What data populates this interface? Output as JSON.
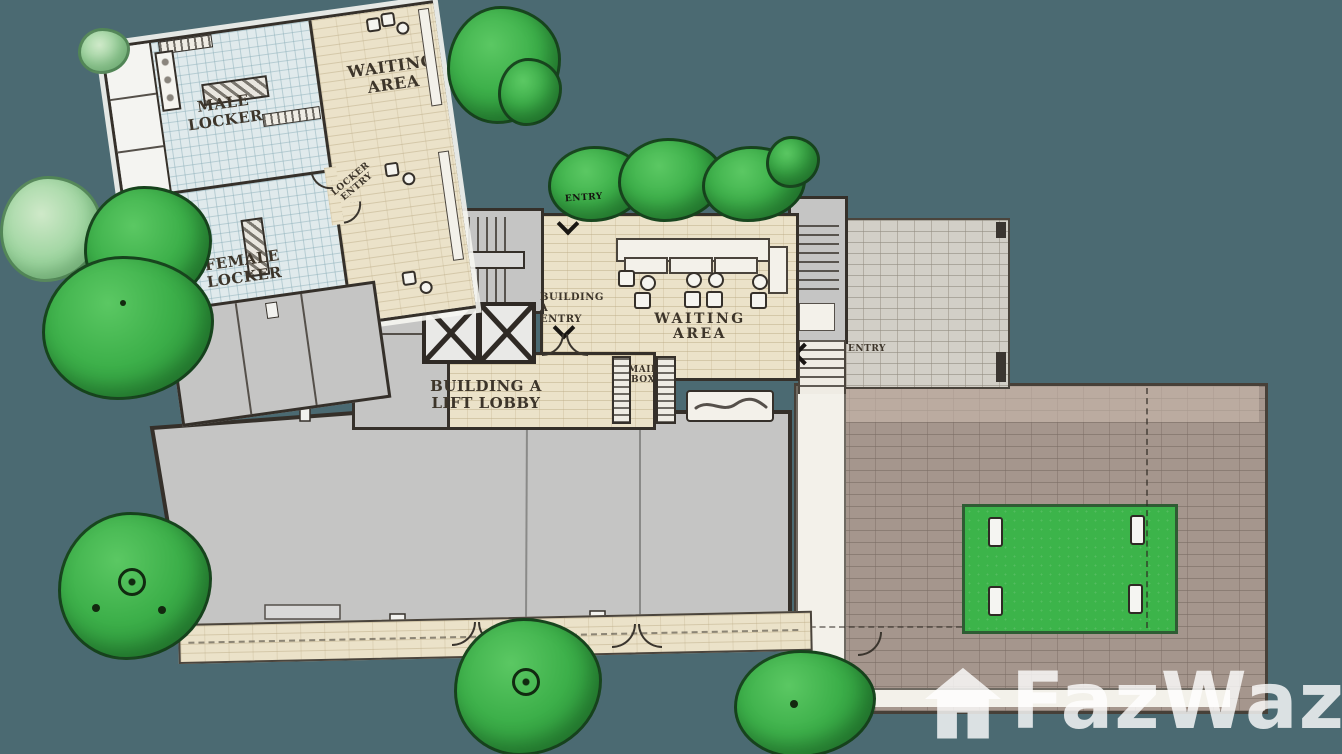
{
  "title": "Building A ground floor plan with locker facilities and entry court",
  "labels": {
    "locker_waiting": {
      "l1": "WAITING",
      "l2": "AREA"
    },
    "male_locker": "MALE LOCKER",
    "female_locker": {
      "l1": "FEMALE",
      "l2": "LOCKER"
    },
    "locker_entry": {
      "l1": "LOCKER",
      "l2": "ENTRY"
    },
    "top_entry": "ENTRY",
    "building_a_entry": {
      "l1": "BUILDING A",
      "l2": "ENTRY"
    },
    "main_waiting": "WAITING AREA",
    "lift_lobby": {
      "l1": "BUILDING A",
      "l2": "LIFT LOBBY"
    },
    "mail_box": {
      "l1": "MAIL",
      "l2": "BOX"
    },
    "side_entry": "ENTRY"
  },
  "watermark": {
    "brand": "FazWaz",
    "icon": "house-icon"
  },
  "colors": {
    "background": "#4b6a72",
    "tile_floor": "#e0eaec",
    "beige_paving": "#ebe2c9",
    "plaza_brick": "#a5968d",
    "cobble_paving": "#d2cfc7",
    "wall_gray": "#c5c5c4",
    "wall_line": "#35302a",
    "lawn_green": "#3cb44a",
    "tree_green": "#35a342",
    "walkway_white": "#f3f1ea",
    "watermark_white": "rgba(255,255,255,0.8)"
  }
}
